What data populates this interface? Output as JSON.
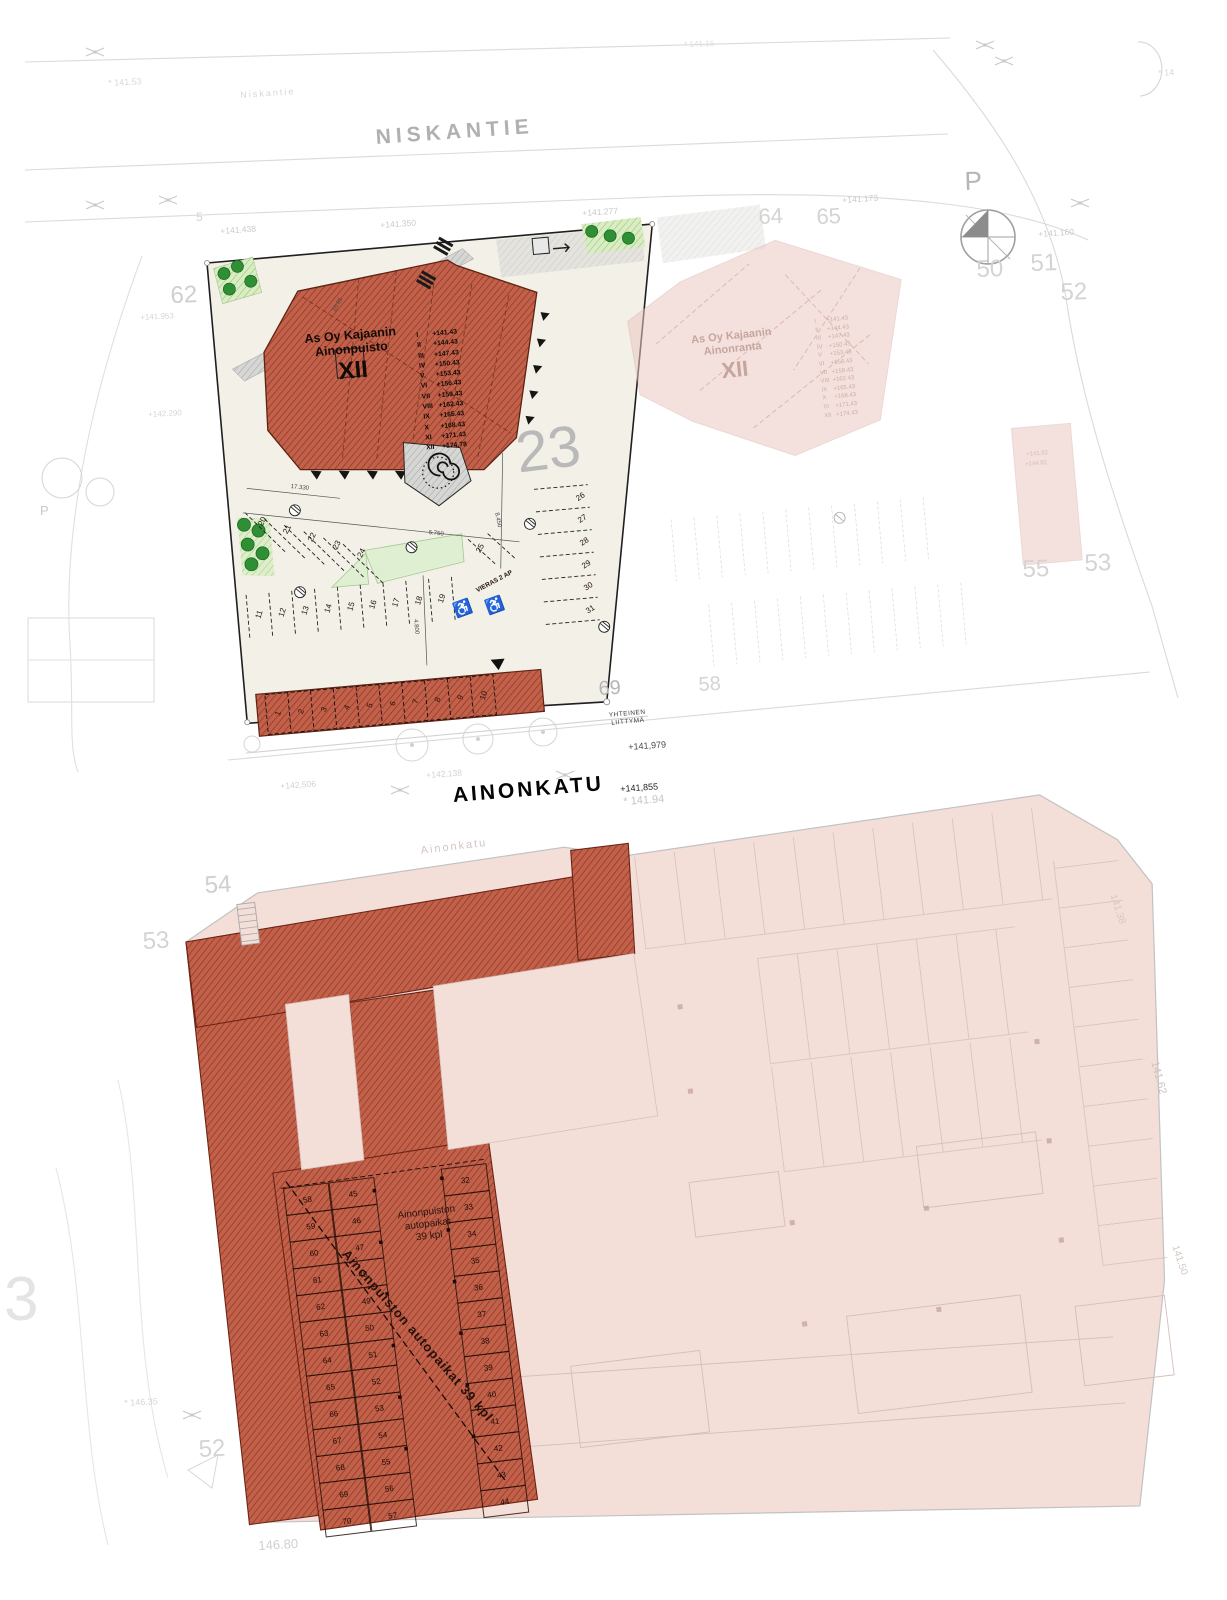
{
  "streets": {
    "niskantie_main": "NISKANTIE",
    "niskantie_small": "Niskantie",
    "ainonkatu_main": "AINONKATU",
    "ainonkatu_faint": "Ainonkatu"
  },
  "north": {
    "label": "P"
  },
  "buildings": {
    "ainonpuisto": {
      "name1": "As Oy Kajaanin",
      "name2": "Ainonpuisto",
      "roman": "XII",
      "floors": [
        {
          "n": "I",
          "e": "+141.43"
        },
        {
          "n": "II",
          "e": "+144.43"
        },
        {
          "n": "III",
          "e": "+147.43"
        },
        {
          "n": "IV",
          "e": "+150.43"
        },
        {
          "n": "V",
          "e": "+153.43"
        },
        {
          "n": "VI",
          "e": "+156.43"
        },
        {
          "n": "VII",
          "e": "+159.43"
        },
        {
          "n": "VIII",
          "e": "+162.43"
        },
        {
          "n": "IX",
          "e": "+165.43"
        },
        {
          "n": "X",
          "e": "+168.43"
        },
        {
          "n": "XI",
          "e": "+171.43"
        },
        {
          "n": "XII",
          "e": "+174.78"
        }
      ]
    },
    "ainonranta": {
      "name1": "As Oy Kajaanin",
      "name2": "Ainonranta",
      "roman": "XII",
      "floors": [
        {
          "n": "I",
          "e": "+141.43"
        },
        {
          "n": "II",
          "e": "+144.43"
        },
        {
          "n": "III",
          "e": "+147.43"
        },
        {
          "n": "IV",
          "e": "+150.43"
        },
        {
          "n": "V",
          "e": "+153.43"
        },
        {
          "n": "VI",
          "e": "+156.43"
        },
        {
          "n": "VII",
          "e": "+159.43"
        },
        {
          "n": "VIII",
          "e": "+162.43"
        },
        {
          "n": "IX",
          "e": "+165.43"
        },
        {
          "n": "X",
          "e": "+168.43"
        },
        {
          "n": "XI",
          "e": "+171.43"
        },
        {
          "n": "XII",
          "e": "+174.43"
        }
      ]
    }
  },
  "parcels": [
    "62",
    "64",
    "65",
    "50",
    "51",
    "52",
    "23",
    "55",
    "53",
    "58",
    "69",
    "54",
    "53",
    "52",
    "3",
    "5",
    "P"
  ],
  "elevations": [
    "* 141.53",
    "* 141.16",
    "* 14",
    "+141.438",
    "+141.350",
    "+141.277",
    "+141.173",
    "+141.160",
    "+141.953",
    "+142.290",
    "+141,979",
    "+141,855",
    "* 141.94",
    "+142,138",
    "+142,506",
    "146.80",
    "* 146.35",
    "141.38",
    "141.62",
    "141.50",
    "+141.82",
    "+144.82"
  ],
  "dimensions": [
    "17.330",
    "5.750",
    "8.450",
    "4.800",
    "25.81"
  ],
  "site": {
    "visitor": "VIERAS 2 AP",
    "junction1": "YHTEINEN",
    "junction2": "LIITTYMÄ",
    "accessible_symbol": "♿",
    "stalls_front": [
      "11",
      "12",
      "13",
      "14",
      "15",
      "16",
      "17",
      "18",
      "19"
    ],
    "stalls_west": [
      "20",
      "21",
      "22",
      "23",
      "24"
    ],
    "stall_25": "25",
    "stalls_east": [
      "26",
      "27",
      "28",
      "29",
      "30",
      "31"
    ],
    "carport": [
      "1",
      "2",
      "3",
      "4",
      "5",
      "6",
      "7",
      "8",
      "9",
      "10"
    ]
  },
  "garage": {
    "label1": "Ainonpuiston",
    "label2": "autopaikat",
    "label3": "39 kpl",
    "diagonal_label": "Ainonpuiston autopaikat 39 kpl",
    "col_left": [
      "58",
      "59",
      "60",
      "61",
      "62",
      "63",
      "64",
      "65",
      "66",
      "67",
      "68",
      "69",
      "70"
    ],
    "col_mid": [
      "45",
      "46",
      "47",
      "48",
      "49",
      "50",
      "51",
      "52",
      "53",
      "54",
      "55",
      "56",
      "57"
    ],
    "col_right": [
      "32",
      "33",
      "34",
      "35",
      "36",
      "37",
      "38",
      "39",
      "40",
      "41",
      "42",
      "43",
      "44"
    ]
  },
  "colors": {
    "red_hatch": "#c2604a",
    "faded_pink": "#f3ded8",
    "lot_cream": "#f2f0e7"
  }
}
